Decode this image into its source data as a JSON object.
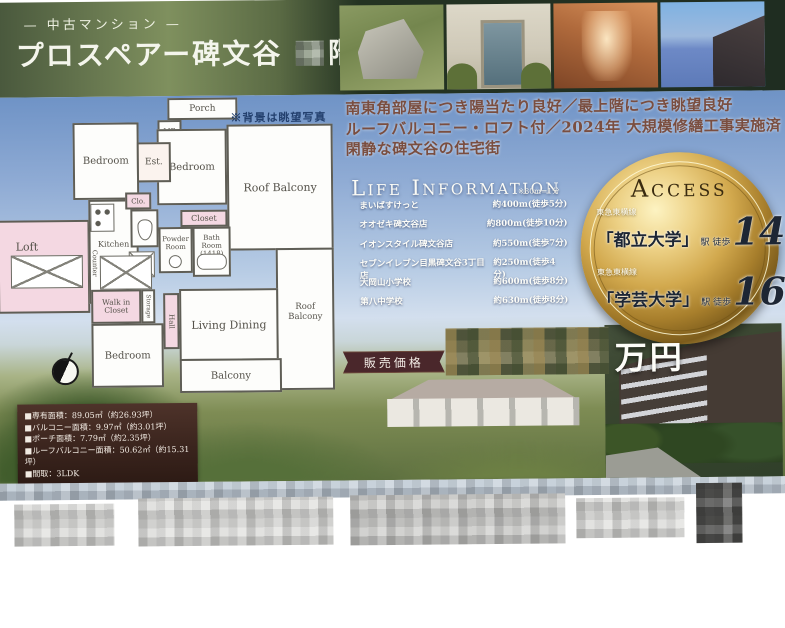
{
  "header": {
    "category_display": "— 中古マンション —",
    "building_name": "プロスペアー碑文谷",
    "floor_suffix": "階"
  },
  "catchcopy": {
    "line1": "南東角部屋につき陽当たり良好／最上階につき眺望良好",
    "line2": "ルーフバルコニー・ロフト付／2024年 大規模修繕工事実施済",
    "line3": "閑静な碑文谷の住宅街"
  },
  "life_information": {
    "title": "Life Information",
    "note": "※80m=1分",
    "items": [
      {
        "name": "まいばすけっと",
        "distance": "約400m(徒歩5分)"
      },
      {
        "name": "オオゼキ碑文谷店",
        "distance": "約800m(徒歩10分)"
      },
      {
        "name": "イオンスタイル碑文谷店",
        "distance": "約550m(徒歩7分)"
      },
      {
        "name": "セブンイレブン目黒碑文谷3丁目店",
        "distance": "約250m(徒歩4分)"
      },
      {
        "name": "大岡山小学校",
        "distance": "約600m(徒歩8分)"
      },
      {
        "name": "第八中学校",
        "distance": "約630m(徒歩8分)"
      }
    ]
  },
  "access": {
    "title": "Access",
    "stations": [
      {
        "line": "東急東横線",
        "station": "「都立大学」",
        "walk_label": "駅 徒歩",
        "minutes": "14",
        "unit": "分"
      },
      {
        "line": "東急東横線",
        "station": "「学芸大学」",
        "walk_label": "駅 徒歩",
        "minutes": "16",
        "unit": "分"
      }
    ]
  },
  "price": {
    "label": "販売価格",
    "unit": "万円"
  },
  "details": {
    "items": [
      "■専有面積：89.05㎡（約26.93坪）",
      "■バルコニー面積：9.97㎡（約3.01坪）",
      "■ポーチ面積：7.79㎡（約2.35坪）",
      "■ルーフバルコニー面積：50.62㎡（約15.31坪）",
      "■間取：3LDK"
    ]
  },
  "floorplan": {
    "note": "※背景は眺望写真",
    "rooms": {
      "porch": "Porch",
      "mb": "MB",
      "est": "Est.",
      "bedroom_top": "Bedroom",
      "bedroom_mid": "Bedroom",
      "roof_balcony_top": "Roof Balcony",
      "roof_balcony_side": "Roof Balcony",
      "loft": "Loft",
      "kitchen": "Kitchen",
      "clo": "Clo.",
      "closet": "Closet",
      "powder_room": "Powder Room",
      "bath_room": "Bath Room\n(1418)",
      "counter": "Counter",
      "walkin_closet": "Walk in Closet",
      "storage": "Storage",
      "hall": "Hall",
      "bedroom_bottom": "Bedroom",
      "living_dining": "Living Dining",
      "balcony": "Balcony"
    }
  },
  "colors": {
    "header_green": "#48573c",
    "gold": "#d2a94e",
    "ribbon_maroon": "#4a272b",
    "catchcopy_brown": "#7a4e40",
    "plan_pink": "#f4d8e2",
    "sky_blue": "#6f93c6"
  }
}
